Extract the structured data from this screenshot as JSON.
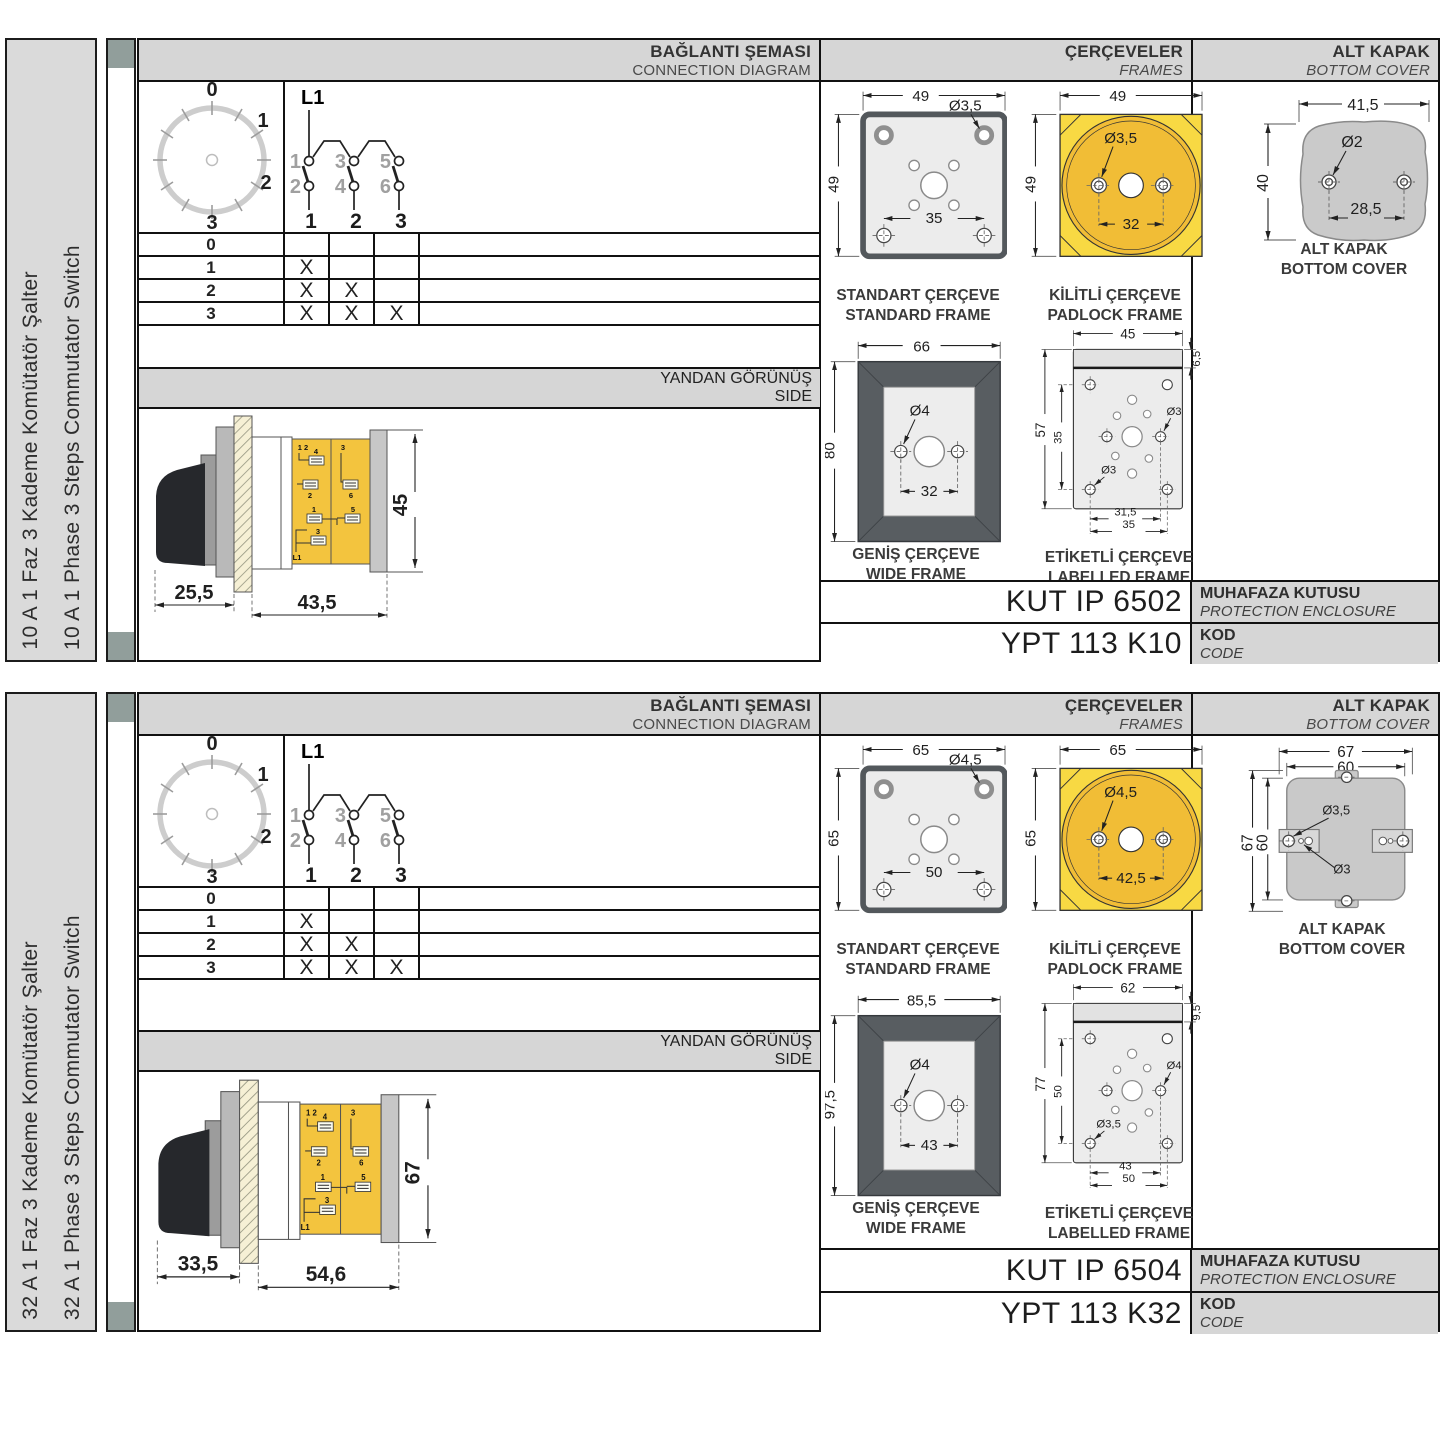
{
  "panels": [
    {
      "sidebar": {
        "tr": "10 A 1 Faz 3 Kademe Komütatör Şalter",
        "en": "10 A 1 Phase 3 Steps Commutator Switch"
      },
      "headers": {
        "connection": {
          "tr": "BAĞLANTI ŞEMASI",
          "en": "CONNECTION DIAGRAM"
        },
        "frames": {
          "tr": "ÇERÇEVELER",
          "en": "FRAMES"
        },
        "cover": {
          "tr": "ALT KAPAK",
          "en": "BOTTOM COVER"
        },
        "side": {
          "tr": "YANDAN GÖRÜNÜŞ",
          "en": "SIDE"
        }
      },
      "dial": {
        "p0": "0",
        "p1": "1",
        "p2": "2",
        "p3": "3"
      },
      "circuit": {
        "phase": "L1",
        "c1": "1",
        "c2": "2",
        "c3": "3",
        "c4": "4",
        "c5": "5",
        "c6": "6",
        "s1": "1",
        "s2": "2",
        "s3": "3"
      },
      "table": {
        "rows": [
          {
            "label": "0",
            "m1": "",
            "m2": "",
            "m3": ""
          },
          {
            "label": "1",
            "m1": "X",
            "m2": "",
            "m3": ""
          },
          {
            "label": "2",
            "m1": "X",
            "m2": "X",
            "m3": ""
          },
          {
            "label": "3",
            "m1": "X",
            "m2": "X",
            "m3": "X"
          }
        ]
      },
      "side_view": {
        "dim_front": "25,5",
        "dim_body": "43,5",
        "dim_height": "45",
        "t12": "1 2",
        "t4": "4",
        "t2": "2",
        "t3": "3",
        "t6": "6",
        "t1": "1",
        "t5": "5",
        "t3b": "3",
        "l1": "L1"
      },
      "frames": {
        "standard": {
          "cap_tr": "STANDART ÇERÇEVE",
          "cap_en": "STANDARD FRAME",
          "w": "49",
          "h": "49",
          "hole": "Ø3,5",
          "span": "35"
        },
        "padlock": {
          "cap_tr": "KİLİTLİ ÇERÇEVE",
          "cap_en": "PADLOCK FRAME",
          "w": "49",
          "h": "49",
          "hole": "Ø3,5",
          "span": "32"
        },
        "wide": {
          "cap_tr": "GENİŞ ÇERÇEVE",
          "cap_en": "WIDE FRAME",
          "w": "66",
          "h": "80",
          "hole": "Ø4",
          "span": "32"
        },
        "labelled": {
          "cap_tr": "ETİKETLİ ÇERÇEVE",
          "cap_en": "LABELLED FRAME",
          "w": "45",
          "strip": "6,5",
          "h": "57",
          "inner": "35",
          "hole_side": "Ø3",
          "hole_corner": "Ø3",
          "span1": "31,5",
          "span2": "35"
        }
      },
      "cover": {
        "cap_tr": "ALT KAPAK",
        "cap_en": "BOTTOM COVER",
        "w": "41,5",
        "h": "40",
        "hole": "Ø2",
        "span": "28,5"
      },
      "enclosure": {
        "value": "KUT IP 6502",
        "tr": "MUHAFAZA KUTUSU",
        "en": "PROTECTION ENCLOSURE"
      },
      "code": {
        "value": "YPT 113 K10",
        "tr": "KOD",
        "en": "CODE"
      }
    },
    {
      "sidebar": {
        "tr": "32 A 1 Faz 3 Kademe Komütatör Şalter",
        "en": "32 A 1 Phase 3 Steps Commutator Switch"
      },
      "headers": {
        "connection": {
          "tr": "BAĞLANTI ŞEMASI",
          "en": "CONNECTION DIAGRAM"
        },
        "frames": {
          "tr": "ÇERÇEVELER",
          "en": "FRAMES"
        },
        "cover": {
          "tr": "ALT KAPAK",
          "en": "BOTTOM COVER"
        },
        "side": {
          "tr": "YANDAN GÖRÜNÜŞ",
          "en": "SIDE"
        }
      },
      "dial": {
        "p0": "0",
        "p1": "1",
        "p2": "2",
        "p3": "3"
      },
      "circuit": {
        "phase": "L1",
        "c1": "1",
        "c2": "2",
        "c3": "3",
        "c4": "4",
        "c5": "5",
        "c6": "6",
        "s1": "1",
        "s2": "2",
        "s3": "3"
      },
      "table": {
        "rows": [
          {
            "label": "0",
            "m1": "",
            "m2": "",
            "m3": ""
          },
          {
            "label": "1",
            "m1": "X",
            "m2": "",
            "m3": ""
          },
          {
            "label": "2",
            "m1": "X",
            "m2": "X",
            "m3": ""
          },
          {
            "label": "3",
            "m1": "X",
            "m2": "X",
            "m3": "X"
          }
        ]
      },
      "side_view": {
        "dim_front": "33,5",
        "dim_body": "54,6",
        "dim_height": "67",
        "t12": "1 2",
        "t4": "4",
        "t2": "2",
        "t3": "3",
        "t6": "6",
        "t1": "1",
        "t5": "5",
        "t3b": "3",
        "l1": "L1"
      },
      "frames": {
        "standard": {
          "cap_tr": "STANDART ÇERÇEVE",
          "cap_en": "STANDARD FRAME",
          "w": "65",
          "h": "65",
          "hole": "Ø4,5",
          "span": "50"
        },
        "padlock": {
          "cap_tr": "KİLİTLİ ÇERÇEVE",
          "cap_en": "PADLOCK FRAME",
          "w": "65",
          "h": "65",
          "hole": "Ø4,5",
          "span": "42,5"
        },
        "wide": {
          "cap_tr": "GENİŞ ÇERÇEVE",
          "cap_en": "WIDE FRAME",
          "w": "85,5",
          "h": "97,5",
          "hole": "Ø4",
          "span": "43"
        },
        "labelled": {
          "cap_tr": "ETİKETLİ ÇERÇEVE",
          "cap_en": "LABELLED FRAME",
          "w": "62",
          "strip": "9,5",
          "h": "77",
          "inner": "50",
          "hole_side": "Ø4",
          "hole_corner": "Ø3,5",
          "span1": "43",
          "span2": "50"
        }
      },
      "cover": {
        "cap_tr": "ALT KAPAK",
        "cap_en": "BOTTOM COVER",
        "w": "67",
        "w2": "60",
        "h": "67",
        "h2": "60",
        "hole1": "Ø3,5",
        "hole2": "Ø3"
      },
      "enclosure": {
        "value": "KUT IP 6504",
        "tr": "MUHAFAZA KUTUSU",
        "en": "PROTECTION ENCLOSURE"
      },
      "code": {
        "value": "YPT 113 K32",
        "tr": "KOD",
        "en": "CODE"
      }
    }
  ]
}
